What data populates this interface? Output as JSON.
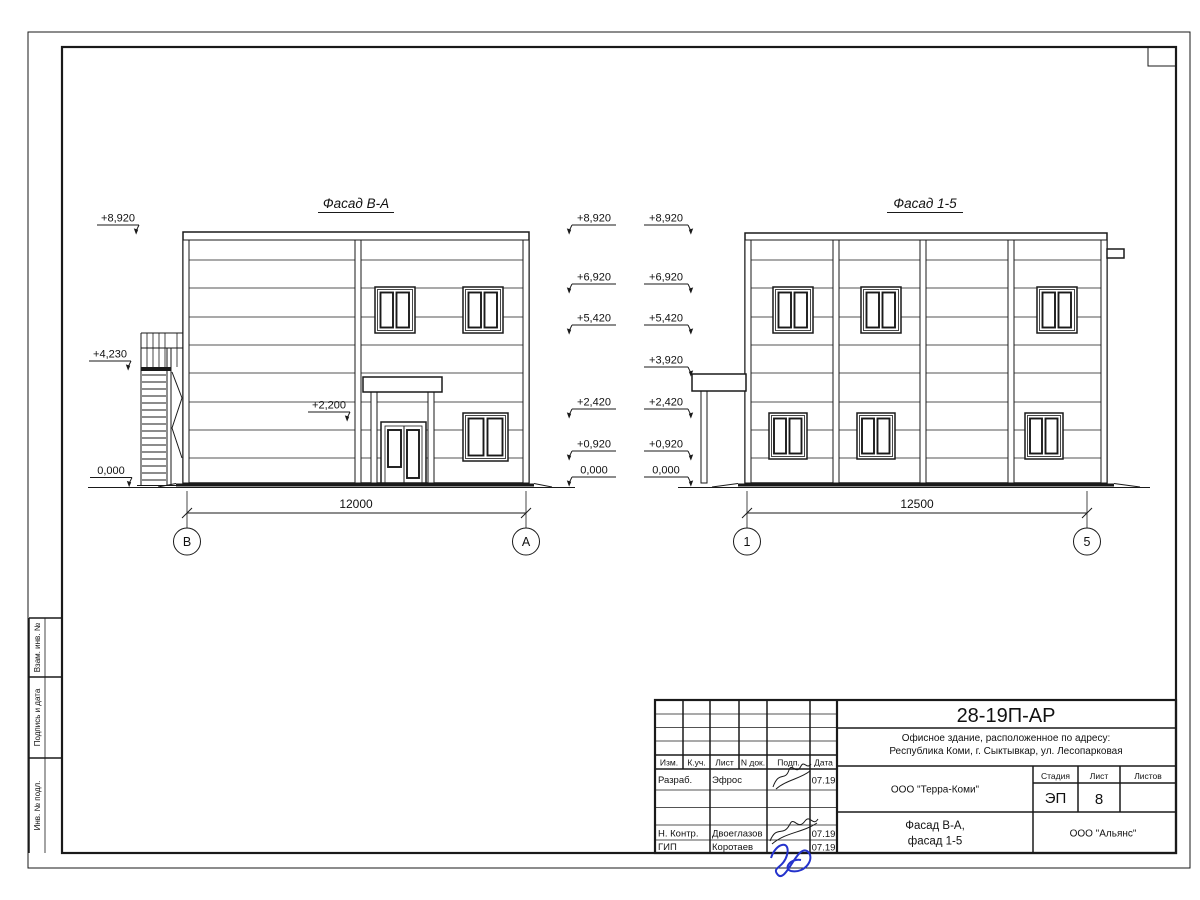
{
  "drawing": {
    "facade_ba": {
      "title": "Фасад В-А",
      "elevations_left": [
        "+8,920",
        "+4,230",
        "0,000"
      ],
      "elevation_inner": "+2,200",
      "elevations_right": [
        "+8,920",
        "+6,920",
        "+5,420",
        "+2,420",
        "+0,920",
        "0,000"
      ],
      "dimension": "12000",
      "axis_left": "В",
      "axis_right": "А"
    },
    "facade_15": {
      "title": "Фасад 1-5",
      "elevations_left": [
        "+8,920",
        "+6,920",
        "+5,420",
        "+3,920",
        "+2,420",
        "+0,920",
        "0,000"
      ],
      "dimension": "12500",
      "axis_left": "1",
      "axis_right": "5"
    }
  },
  "title_block": {
    "doc_number": "28-19П-АР",
    "description": [
      "Офисное здание, расположенное по адресу:",
      "Республика Коми, г. Сыктывкар, ул. Лесопарковая"
    ],
    "columns": [
      "Изм.",
      "К.уч.",
      "Лист",
      "N док.",
      "Подп.",
      "Дата"
    ],
    "staff": [
      {
        "role": "Разраб.",
        "name": "Эфрос",
        "date": "07.19"
      },
      {
        "role": "Н. Контр.",
        "name": "Двоеглазов",
        "date": "07.19"
      },
      {
        "role": "ГИП",
        "name": "Коротаев",
        "date": "07.19"
      }
    ],
    "client_org": "ООО \"Терра-Коми\"",
    "stage_label": "Стадия",
    "stage_value": "ЭП",
    "sheet_label": "Лист",
    "sheet_value": "8",
    "sheets_label": "Листов",
    "drawing_title": [
      "Фасад В-А,",
      "фасад 1-5"
    ],
    "author_org": "ООО \"Альянс\""
  },
  "side_stamps": [
    "Взам. инв. №",
    "Подпись и дата",
    "Инв. № подл."
  ]
}
